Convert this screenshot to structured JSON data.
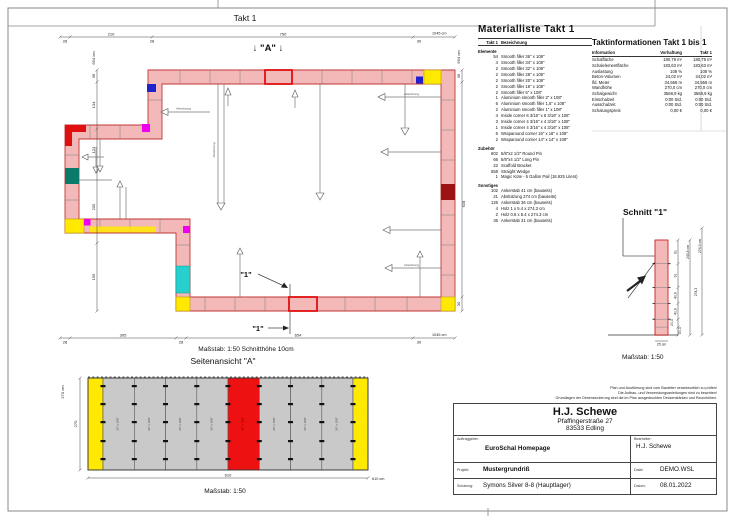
{
  "header": {
    "takt_title": "Takt 1"
  },
  "plan": {
    "a_marker": "↓ \"A\" ↓",
    "section_label": "\"1\"",
    "brace_label": "Abstützung",
    "scale_note": "Maßstab: 1:50   Schnitthöhe 10cm",
    "dims": {
      "top": [
        "28",
        "210",
        "28",
        "750",
        "30",
        "1045 cm"
      ],
      "bottom": [
        "28",
        "305",
        "28",
        "654",
        "30",
        "1045 cm"
      ],
      "left": [
        "694 cm",
        "36",
        "134",
        "124",
        "205",
        "195"
      ],
      "right": [
        "694 cm",
        "36",
        "628",
        "30"
      ]
    }
  },
  "sideview": {
    "title": "Seitenansicht \"A\"",
    "height": "270",
    "height_cm": "270 cm",
    "width": "610",
    "width_cm": "610 cm",
    "scale": "Maßstab: 1:50",
    "panel_label": "36\" x 108\""
  },
  "schnitt": {
    "title": "Schnitt \"1\"",
    "segments": [
      "61",
      "61",
      "40,6",
      "40,6",
      "20,3",
      "20,3"
    ],
    "wall_height": "243,8 cm",
    "total_height": "274,3 cm",
    "total_mid": "274,3",
    "base_width": "25 cm",
    "scale": "Maßstab: 1:50"
  },
  "material_list": {
    "title": "Materialliste  Takt 1",
    "col_qty": "Takt 1",
    "col_name": "Bezeichnung",
    "sections": [
      {
        "heading": "Elemente",
        "rows": [
          {
            "qty": "54",
            "name": "Smooth filler 36\" x 108\""
          },
          {
            "qty": "4",
            "name": "Smooth filler 34\" x 108\""
          },
          {
            "qty": "2",
            "name": "Smooth filler 32\" x 108\""
          },
          {
            "qty": "2",
            "name": "Smooth filler 28\" x 108\""
          },
          {
            "qty": "2",
            "name": "Smooth filler 20\" x 108\""
          },
          {
            "qty": "2",
            "name": "Smooth filler 16\" x 108\""
          },
          {
            "qty": "2",
            "name": "Smooth filler 5\" x 108\""
          },
          {
            "qty": "1",
            "name": "Aluminium smooth filler 2\" x 108\""
          },
          {
            "qty": "6",
            "name": "Aluminium smooth filler 1,5\" x 108\""
          },
          {
            "qty": "2",
            "name": "Aluminium smooth filler 1\" x 108\""
          },
          {
            "qty": "4",
            "name": "Inside corner 6 3/16\" x 6 3/16\" x 108\""
          },
          {
            "qty": "3",
            "name": "Inside corner 4 3/16\" x 4 3/16\" x 108\""
          },
          {
            "qty": "1",
            "name": "Inside corner 4 3/16\" x 4 3/16\" x 108\""
          },
          {
            "qty": "6",
            "name": "Wraparound corner 16\" x 16\" x 108\""
          },
          {
            "qty": "2",
            "name": "Wraparound corner 14\" x 14\" x 108\""
          }
        ]
      },
      {
        "heading": "Zubehör",
        "rows": [
          {
            "qty": "602",
            "name": "5/8\"x2 1/2\" Round Pin"
          },
          {
            "qty": "66",
            "name": "5/8\"x4 1/2\" Long Pin"
          },
          {
            "qty": "22",
            "name": "Scaffold Bracket"
          },
          {
            "qty": "558",
            "name": "Straight Wedge"
          },
          {
            "qty": "1",
            "name": "Magic Kote - 5 Gallon Pail (18.925 Liters)"
          }
        ]
      },
      {
        "heading": "Sonstiges",
        "rows": [
          {
            "qty": "102",
            "name": "Ankerstab 41 cm (bauseits)"
          },
          {
            "qty": "21",
            "name": "Abstützung 274 cm (bauseits)"
          },
          {
            "qty": "126",
            "name": "Ankerstab 36 cm (bauseits)"
          },
          {
            "qty": "4",
            "name": "Holz 1 x 5.4 x 274.3 cm"
          },
          {
            "qty": "2",
            "name": "Holz 0.8 x 5.4 x 274.3 cm"
          },
          {
            "qty": "36",
            "name": "Ankerstab 31 cm (bauseits)"
          }
        ]
      }
    ]
  },
  "takt_info": {
    "title": "Taktinformationen  Takt 1 bis 1",
    "columns": [
      "Information",
      "Vorhaltung",
      "Takt 1"
    ],
    "rows": [
      [
        "Schalfläche",
        "180,79 m²",
        "180,79 m²"
      ],
      [
        "Schalelementfläche",
        "183,63 m²",
        "183,63 m²"
      ],
      [
        "Auslastung",
        "108 %",
        "108 %"
      ],
      [
        "Beton-Volumen",
        "24,02 m³",
        "24,02 m³"
      ],
      [
        "lfd. Meter",
        "34,558 m",
        "34,558 m"
      ],
      [
        "Wandhöhe",
        "270,0 cm",
        "270,0 cm"
      ],
      [
        "Schalgewicht",
        "3568,9 kg",
        "3568,9 kg"
      ],
      [
        "Einschalzeit",
        "0:00 Std.",
        "0:00 Std."
      ],
      [
        "Ausschalzeit",
        "0:00 Std.",
        "0:00 Std."
      ],
      [
        "Schalungspreis",
        "0,00 €",
        "0,00 €"
      ]
    ]
  },
  "title_block": {
    "disclaimer_lines": [
      "Plan und Ausführung sind vom Bauleiter verantwortlich zu prüfen!",
      "Die Aufbau- und Verwendungsanleitungen sind zu beachten!",
      "Grundlagen der Dimensionierung sind die im Plan ausgedruckten Deckenstärken und Raumhöhen."
    ],
    "company": {
      "name": "H.J. Schewe",
      "street": "Pfaffingerstraße 27",
      "city": "83533 Edling"
    },
    "fields": {
      "client_label": "Auftraggeber:",
      "client": "EuroSchal Homepage",
      "editor_label": "Bearbeiter:",
      "editor": "H.J. Schewe",
      "project_label": "Projekt:",
      "project": "Mustergrundriß",
      "file_label": "Datei:",
      "file": "DEMO.WSL",
      "formwork_label": "Schalung:",
      "formwork": "Symons Silver 8-8 (Hauptlager)",
      "date_label": "Datum:",
      "date": "08.01.2022"
    }
  }
}
